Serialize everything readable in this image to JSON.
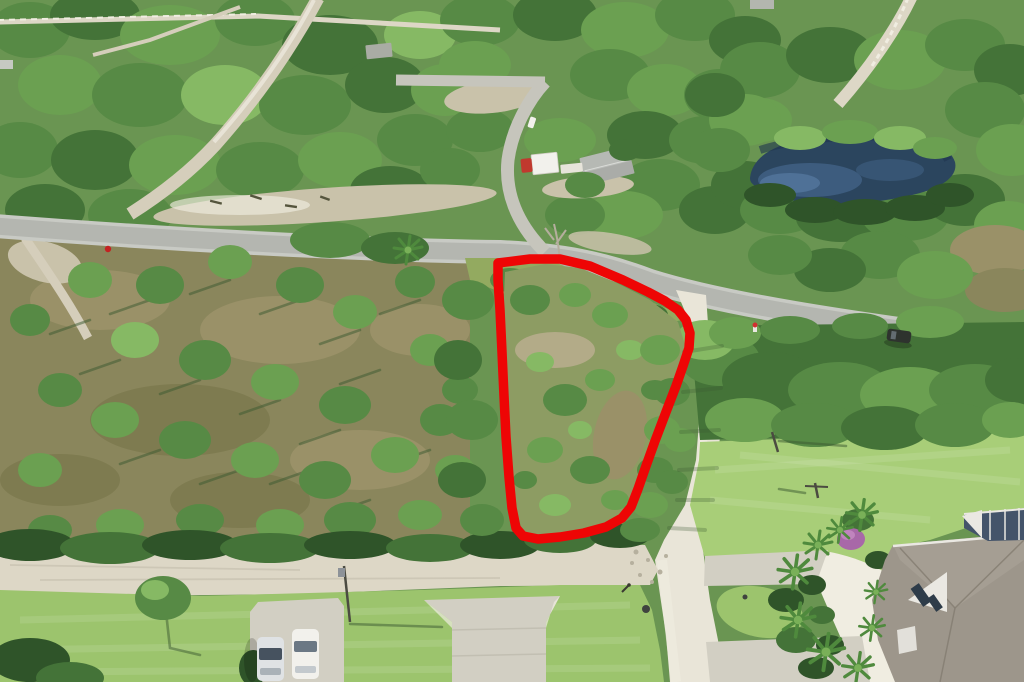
{
  "scene": {
    "description": "Aerial drone photo of a vacant wooded residential lot outlined in red, in a Florida pine-scrub neighborhood with paved and white gravel roads, a dark pond upper right, a utility truck and gray-roof shed near the top intersection, two parked cars on a driveway lower left, and a large taupe-roof house with palm trees and pool screen enclosure at lower right",
    "type": "aerial-photograph"
  },
  "lot_boundary": {
    "points": "498,263 530,259 560,259 590,266 623,280 648,292 665,301 678,310 686,320 690,333 689,348 683,366 676,386 666,412 655,441 646,466 638,489 631,507 622,518 606,527 584,533 560,537 538,539 523,536 516,528 512,508 509,477 506,437 504,396 502,352 500,310 498,280",
    "stroke_width": 9.5
  },
  "palette": {
    "base-green": "#6a9552",
    "canopy-darkest": "#2f5429",
    "canopy-dark": "#447338",
    "canopy-mid": "#578a45",
    "canopy-light": "#6ba051",
    "canopy-bright": "#86b964",
    "ground-olive": "#8a865c",
    "ground-brown": "#9a9168",
    "ground-brown2": "#7e7b50",
    "ground-tan": "#b3ab88",
    "sand": "#ddd7c6",
    "sand-bright": "#f0ede1",
    "gravel": "#e9e5d8",
    "pavement": "#b4b6b0",
    "pavement-edge": "#c8cac4",
    "concrete": "#d2cfc3",
    "trail": "#d5cebb",
    "clearing": "#c9c2aa",
    "pond-deep": "#2b455e",
    "pond-mid": "#3d5c7e",
    "pond-light": "#54779d",
    "lawn": "#9cc46d",
    "lawn-bright": "#a8ce78",
    "verge": "#a6c873",
    "roof-taupe": "#9d968b",
    "roof-dark": "#847d71",
    "trim-white": "#eae8e2",
    "cage-dark": "#44546a",
    "palm-dark": "#4f8a3d",
    "palm-light": "#79b058",
    "bougainvillea": "#a868a8",
    "truck-red": "#c0392e",
    "vehicle-white": "#f2f1ec",
    "car-glass": "#46525f",
    "pole-dark": "#4b4b41",
    "trunk-shadow": "#3c5a32",
    "stop-sign-red": "#c32222",
    "suv-dark": "#2e332e",
    "lot-red": "#ee0505"
  },
  "objects": {
    "outlined_lot": "vacant treed parcel marked with red boundary",
    "pond": "dark blue pond upper right",
    "paved_road": "gray paved road crossing image diagonally",
    "gravel_road": "white gravel road along right side of lot",
    "sandy_street": "sandy street across bottom",
    "utility_truck": "red-cab box truck parked near top intersection",
    "shed": "gray metal roof structure near truck",
    "parked_cars": "two white vehicles on lower-left driveway",
    "house": "taupe hip-roof house with pool screen enclosure, palms and bougainvillea lower right"
  }
}
